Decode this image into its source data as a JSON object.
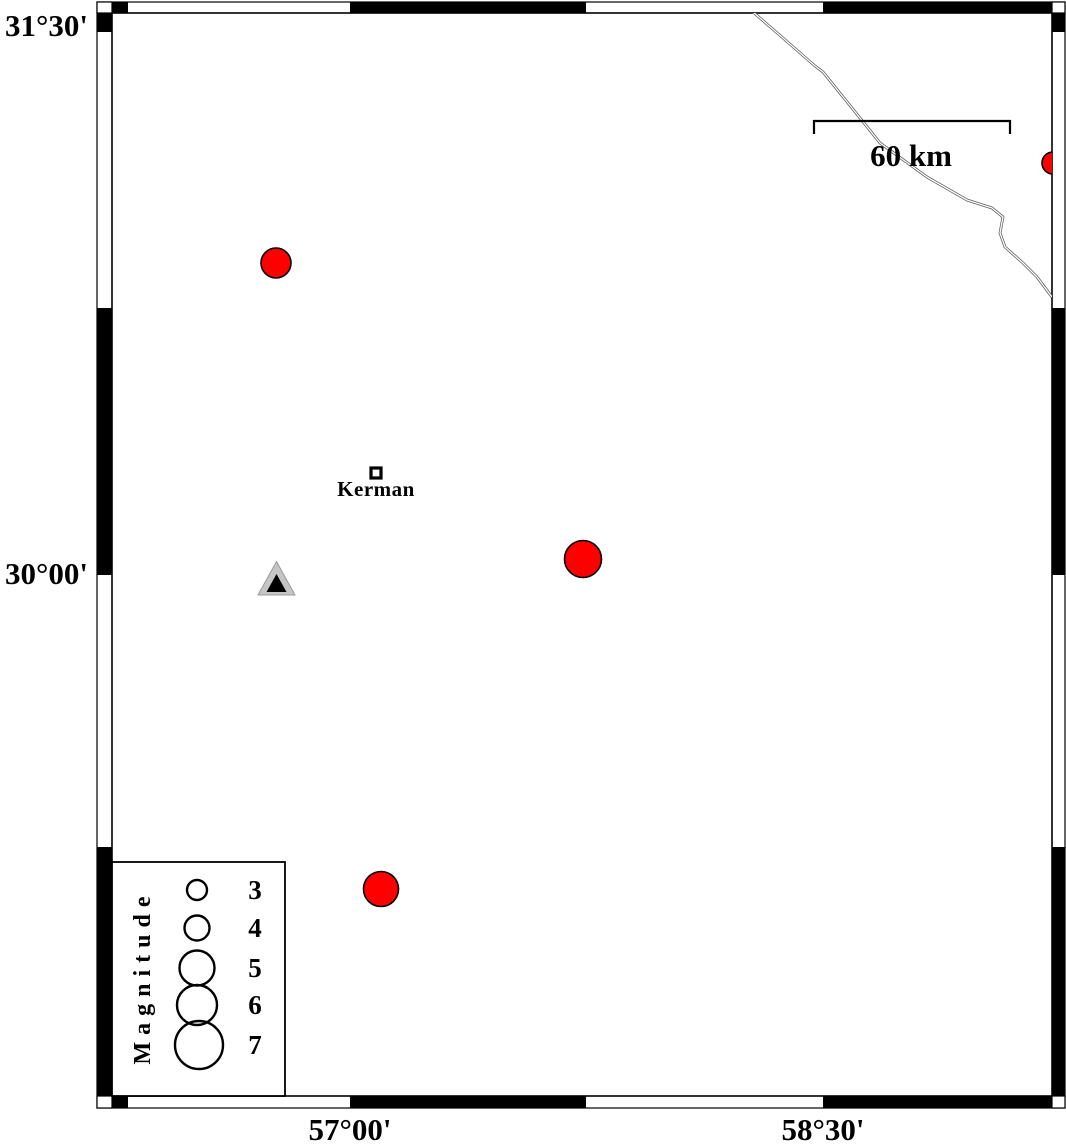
{
  "frame": {
    "lat_labels": [
      {
        "text": "31°30'"
      },
      {
        "text": "30°00'"
      }
    ],
    "lon_labels": [
      {
        "text": "57°00'"
      },
      {
        "text": "58°30'"
      }
    ]
  },
  "scale_bar": {
    "label": "60 km",
    "length_km": 60
  },
  "city": {
    "label": "Kerman"
  },
  "legend": {
    "title": "Magnitude",
    "items": [
      {
        "label": "3",
        "radius_px": 10
      },
      {
        "label": "4",
        "radius_px": 12.5
      },
      {
        "label": "5",
        "radius_px": 17.5
      },
      {
        "label": "6",
        "radius_px": 20
      },
      {
        "label": "7",
        "radius_px": 24
      }
    ]
  },
  "colors": {
    "earthquake_fill": "#ff0000",
    "station_fill": "#c5c5c5",
    "station_inner": "#000000",
    "road_stroke": "#5a5a5a"
  },
  "map_data": {
    "type": "scatter-map",
    "lon_range": [
      56.25,
      59.25
    ],
    "lat_range": [
      29.25,
      31.55
    ],
    "earthquakes": [
      {
        "x": 276,
        "y": 263,
        "radius_px": 15,
        "approx_lon": 56.77,
        "approx_lat": 30.86,
        "approx_magnitude": 4.5
      },
      {
        "x": 583,
        "y": 559,
        "radius_px": 18.5,
        "approx_lon": 57.74,
        "approx_lat": 30.04,
        "approx_magnitude": 5.2
      },
      {
        "x": 381,
        "y": 889,
        "radius_px": 17.5,
        "approx_lon": 57.1,
        "approx_lat": 29.13,
        "approx_magnitude": 5.0
      },
      {
        "x": 1053,
        "y": 163,
        "radius_px": 11,
        "approx_lon": 59.23,
        "approx_lat": 31.14,
        "approx_magnitude": 3.5
      }
    ],
    "station": {
      "x": 276.5,
      "y": 578,
      "approx_lon": 56.77,
      "approx_lat": 30.0
    },
    "city_marker": {
      "x": 376,
      "y": 473,
      "approx_lon": 57.08,
      "approx_lat": 30.28
    },
    "road_points": [
      [
        753,
        12
      ],
      [
        783,
        38
      ],
      [
        815,
        66
      ],
      [
        823,
        72
      ],
      [
        856,
        113
      ],
      [
        880,
        143
      ],
      [
        927,
        177
      ],
      [
        967,
        200
      ],
      [
        992,
        208
      ],
      [
        1003,
        217
      ],
      [
        1000,
        233
      ],
      [
        1005,
        247
      ],
      [
        1023,
        263
      ],
      [
        1037,
        277
      ],
      [
        1052,
        297
      ]
    ]
  }
}
